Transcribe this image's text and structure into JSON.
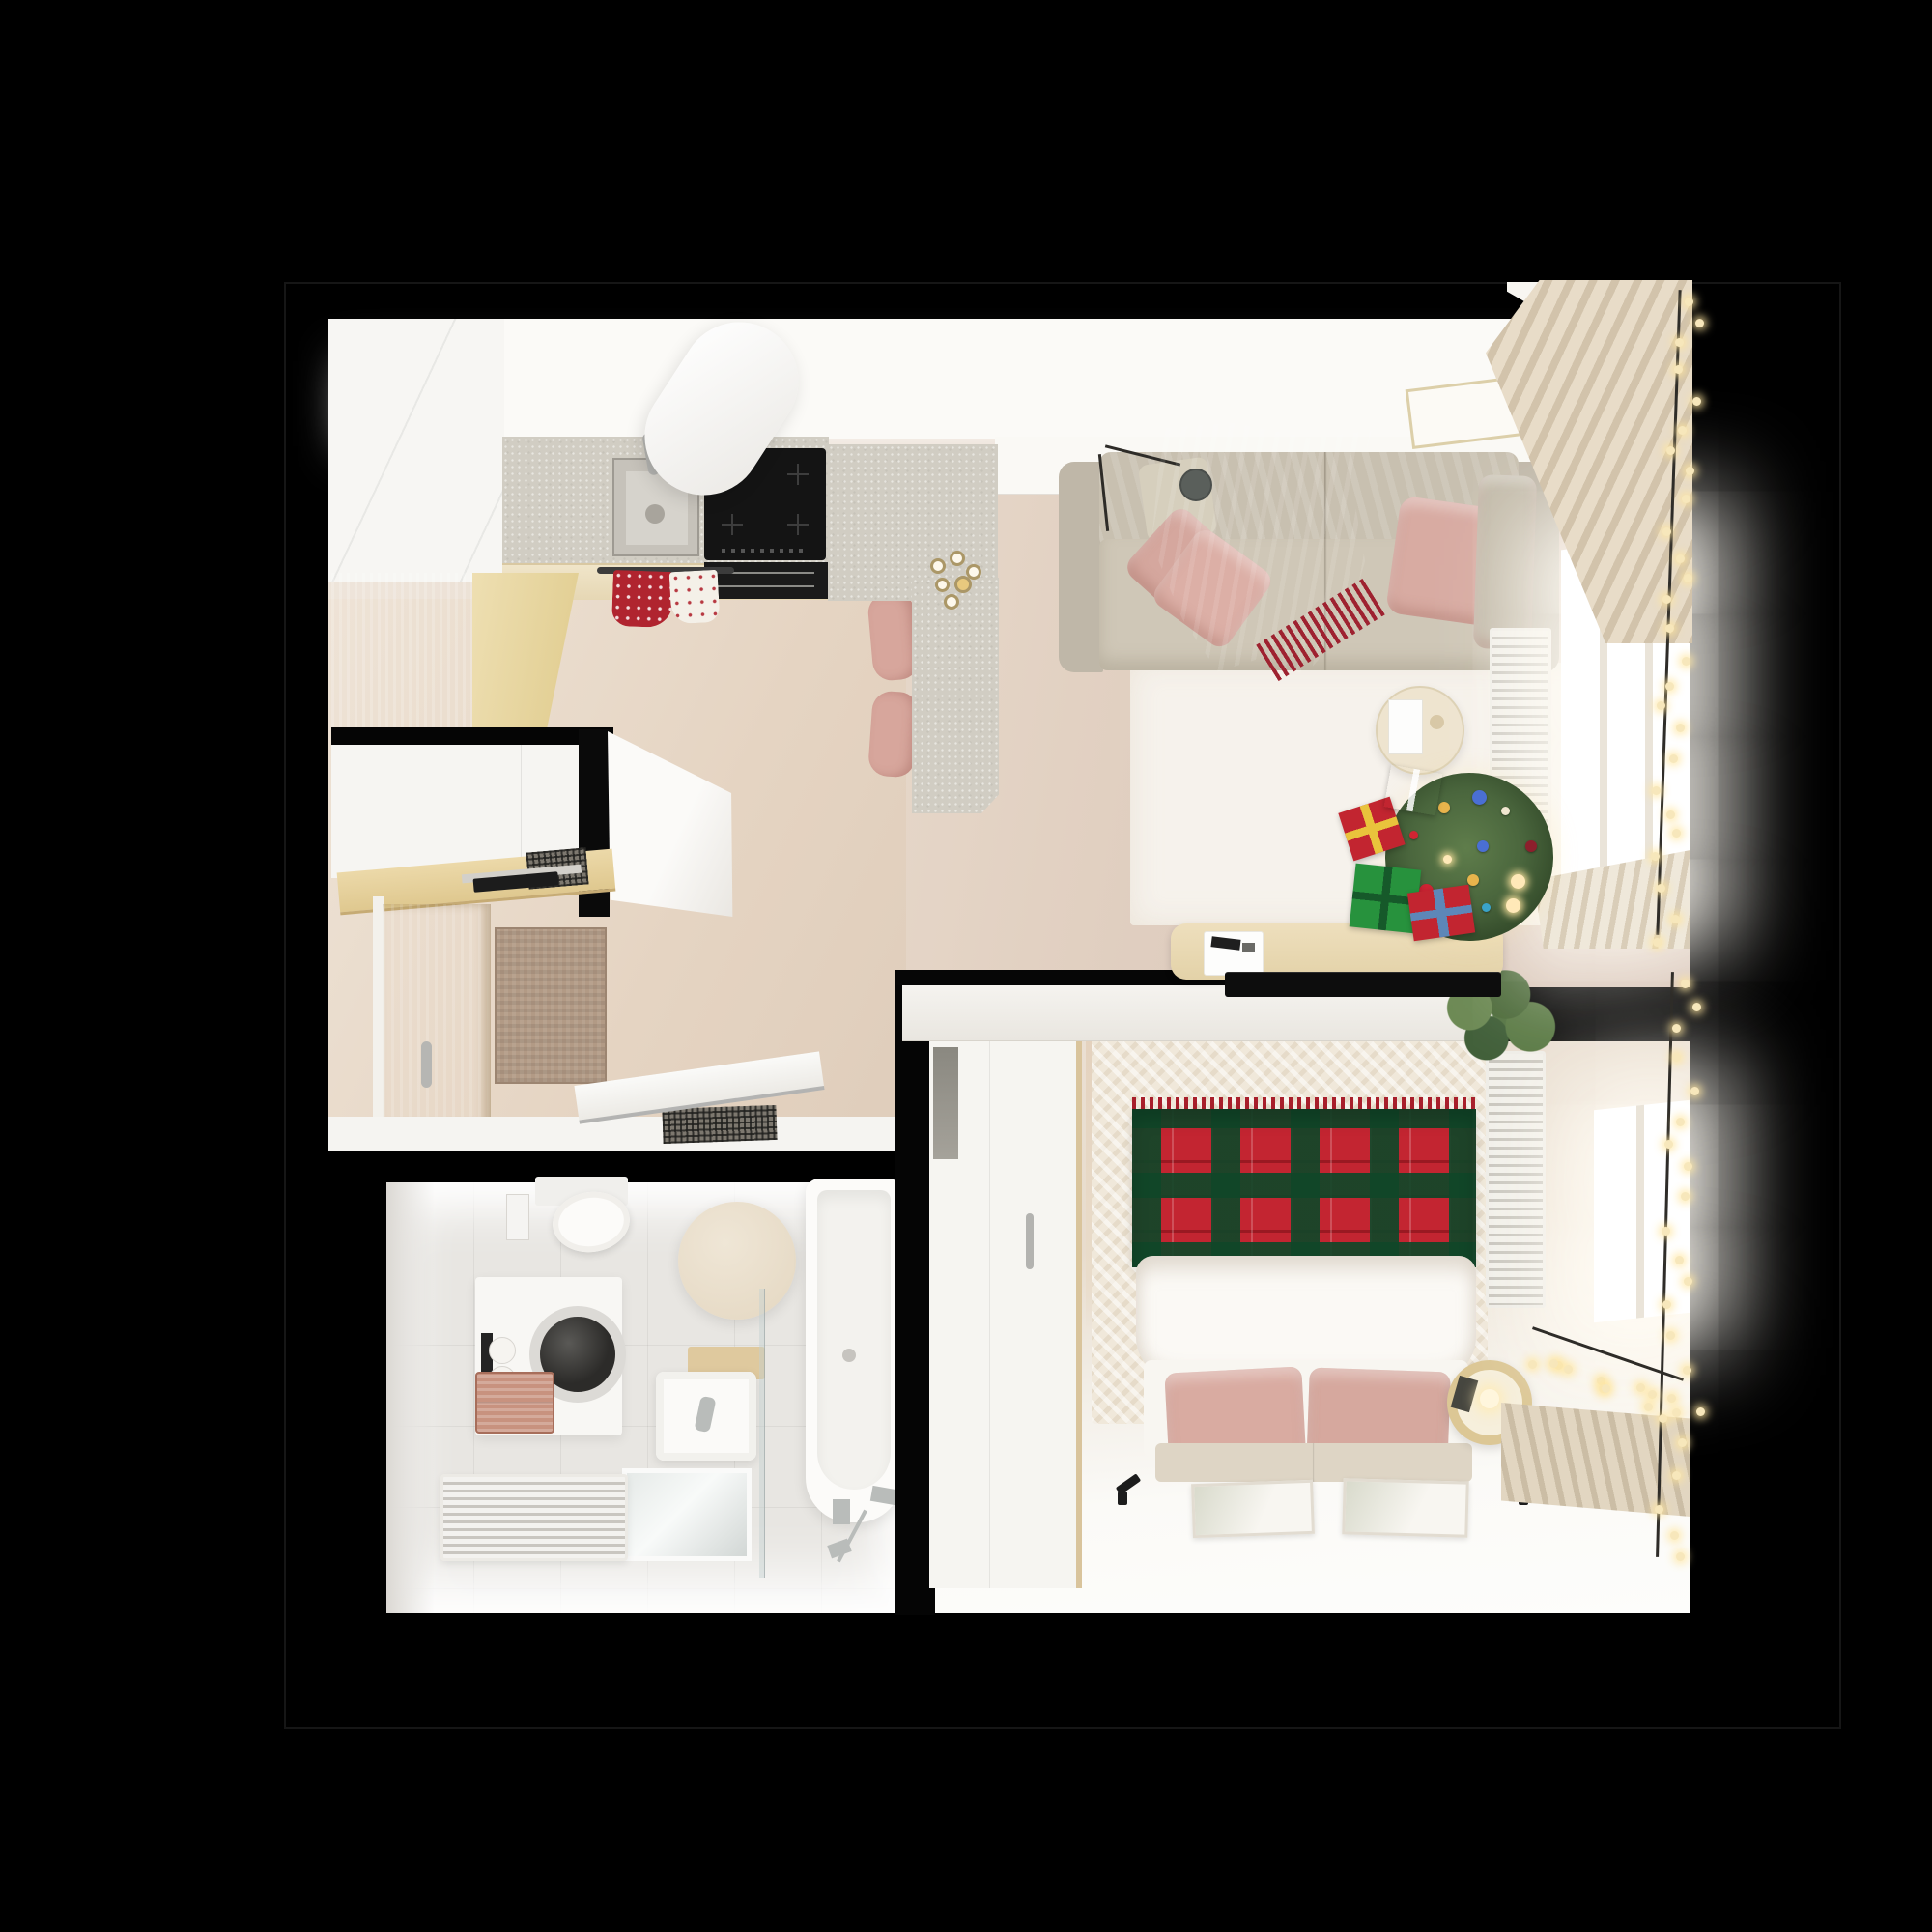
{
  "scene": {
    "type": "apartment-floor-plan-top-view-render",
    "theme": "christmas",
    "background": "#000000"
  },
  "colors": {
    "plaid_red": "#c32531",
    "plaid_green": "#144628",
    "throw_red": "#a2242f",
    "gift_red": "#c22530",
    "gift_green": "#27923d",
    "bow_blue": "#5d87b8",
    "tree_green": "#42603a",
    "pillow_pink": "#d7a9a0",
    "sofa_greige": "#c8c0b0",
    "cabinet_tan": "#d5b672",
    "wood_light": "#e6d2a2",
    "floor_wood": "#e7d8c9",
    "rug_white": "#f6f2ec",
    "bathroom_floor": "#e8e6e2",
    "mirror_beige": "#e9decb",
    "lamp_grey": "#5a5f5b",
    "bulb_warm": "#f7e7bb",
    "wall_black": "#000000",
    "wall_white": "#fbfaf7"
  },
  "decor": {
    "tree_ornament_colors": [
      "#cf2433",
      "#e8b44c",
      "#4a6fd4",
      "#f0e6d0",
      "#8c1f2c",
      "#ffe9b8",
      "#3aa3c9",
      "#e8b44c",
      "#cf2433",
      "#ffe9b8",
      "#4a6fd4",
      "#ffe9b8",
      "#cf2433",
      "#e8b44c"
    ]
  },
  "rooms": [
    {
      "id": "kitchen",
      "label": "Kitchen",
      "items": [
        "tall-cabinets",
        "countertop",
        "sink",
        "faucet",
        "induction-hob",
        "cooker-hood",
        "oven",
        "towel-rail",
        "kitchen-towels",
        "tan-cabinet",
        "kitchen-island",
        "bar-stool",
        "bar-stool",
        "candle-holder"
      ]
    },
    {
      "id": "living-room",
      "label": "Living Room",
      "items": [
        "sofa",
        "back-cushion",
        "pink-pillows",
        "red-throw-blanket",
        "arc-floor-lamp",
        "white-rug",
        "coffee-table",
        "tv-sideboard",
        "tv",
        "christmas-tree",
        "gift-boxes",
        "radiator",
        "window",
        "roman-curtains",
        "string-lights",
        "ceiling-vent",
        "plant"
      ]
    },
    {
      "id": "hallway",
      "label": "Hallway",
      "items": [
        "entrance-door",
        "door-handle",
        "doormat",
        "sliding-wardrobe",
        "coat-shelf",
        "console-grille",
        "open-closet-door",
        "bathroom-door",
        "dark-mat"
      ]
    },
    {
      "id": "bathroom",
      "label": "Bathroom",
      "items": [
        "toilet",
        "light-switch",
        "round-mirror",
        "washing-machine",
        "toilet-paper-holder",
        "laundry-baskets",
        "washbasin",
        "wood-bench",
        "shower-glass",
        "shower-tray",
        "towel-radiator",
        "bathtub",
        "bath-shower-set"
      ]
    },
    {
      "id": "bedroom",
      "label": "Bedroom",
      "items": [
        "wardrobe",
        "bed",
        "tartan-blanket",
        "duvet",
        "bed-pillows",
        "bed-bench",
        "bedroom-rug",
        "nightstand",
        "table-lamp",
        "wall-spotlights",
        "picture-frames",
        "radiator",
        "window",
        "curtains",
        "string-lights",
        "plant"
      ]
    }
  ]
}
